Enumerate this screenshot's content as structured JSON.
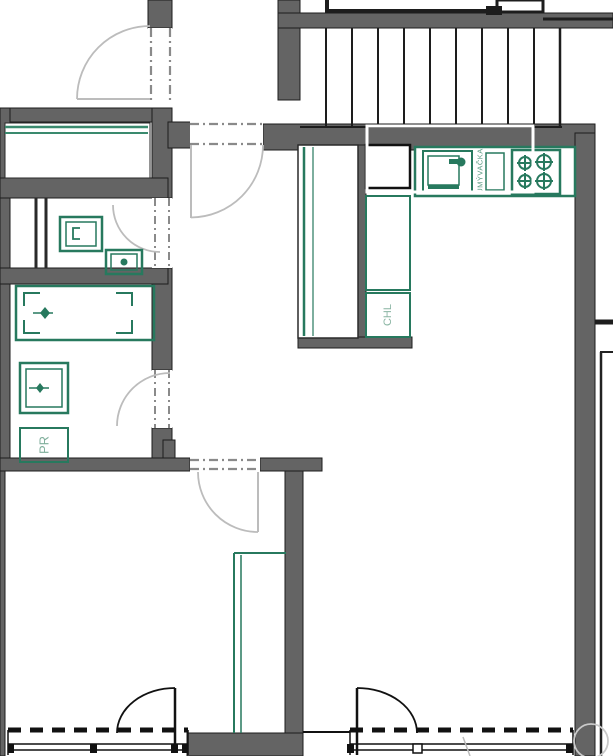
{
  "title": "apartment-floor-plan",
  "labels": {
    "dishwasher": "UMÝVAČKA",
    "fridge": "CHL",
    "washing_machine": "PR"
  },
  "colors": {
    "wall_gray": "#646464",
    "line_black": "#1d1d1d",
    "fixture_green": "#27795e",
    "label_green": "#7fae9b",
    "door_swing_gray": "#bcbcbc",
    "highlight_white": "#ffffff"
  },
  "fixtures": [
    "staircase",
    "entry-closet",
    "wc-washbasin",
    "toilet",
    "bathtub",
    "bath-washbasin",
    "washing-machine",
    "kitchen-counter",
    "kitchen-sink",
    "dishwasher",
    "stove",
    "tall-cabinet",
    "fridge",
    "wardrobe",
    "balcony-door-left",
    "balcony-door-right",
    "window-left",
    "window-right"
  ]
}
